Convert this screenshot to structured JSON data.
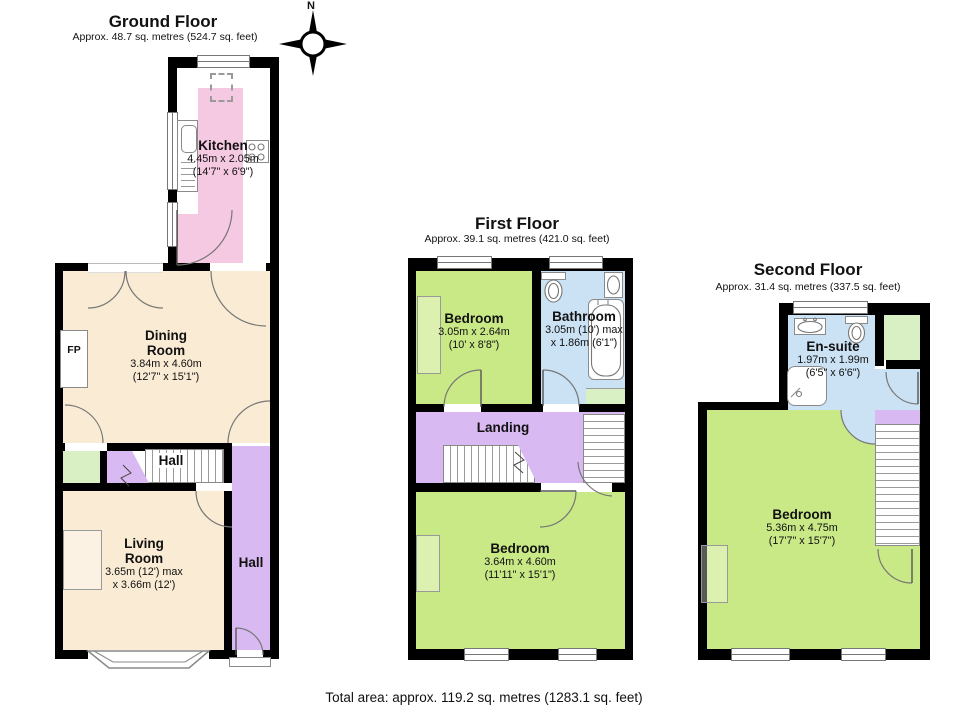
{
  "colors": {
    "page": "#ffffff",
    "wall": "#000000",
    "kitchen": "#f5c9e1",
    "cream": "#faecd4",
    "purple": "#d9b9f1",
    "green": "#c9e886",
    "mint": "#d9efc4",
    "blue": "#cbe2f4"
  },
  "compass": {
    "north": "N"
  },
  "footer": {
    "total_area": "Total area: approx. 119.2 sq. metres (1283.1 sq. feet)"
  },
  "floors": [
    {
      "title": "Ground Floor",
      "subtitle": "Approx. 48.7 sq. metres (524.7 sq. feet)",
      "rooms": [
        {
          "name": "Kitchen",
          "dims1": "4.45m x 2.05m",
          "dims2": "(14'7\" x 6'9\")"
        },
        {
          "name": "Dining",
          "name2": "Room",
          "dims1": "3.84m x 4.60m",
          "dims2": "(12'7\" x 15'1\")"
        },
        {
          "name": "Living",
          "name2": "Room",
          "dims1": "3.65m (12') max",
          "dims2": "x 3.66m (12')"
        }
      ],
      "labels": {
        "fp": "FP",
        "hall_stairs": "Hall",
        "hall_corridor": "Hall"
      }
    },
    {
      "title": "First Floor",
      "subtitle": "Approx. 39.1 sq. metres (421.0 sq. feet)",
      "rooms": [
        {
          "name": "Bedroom",
          "dims1": "3.05m x 2.64m",
          "dims2": "(10' x 8'8\")"
        },
        {
          "name": "Bathroom",
          "dims1": "3.05m (10') max",
          "dims2": "x 1.86m (6'1\")"
        },
        {
          "name": "Bedroom",
          "dims1": "3.64m x 4.60m",
          "dims2": "(11'11\" x 15'1\")"
        }
      ],
      "labels": {
        "landing": "Landing"
      }
    },
    {
      "title": "Second Floor",
      "subtitle": "Approx. 31.4 sq. metres (337.5 sq. feet)",
      "rooms": [
        {
          "name": "En-suite",
          "dims1": "1.97m x 1.99m",
          "dims2": "(6'5\" x 6'6\")"
        },
        {
          "name": "Bedroom",
          "dims1": "5.36m x 4.75m",
          "dims2": "(17'7\" x 15'7\")"
        }
      ]
    }
  ]
}
